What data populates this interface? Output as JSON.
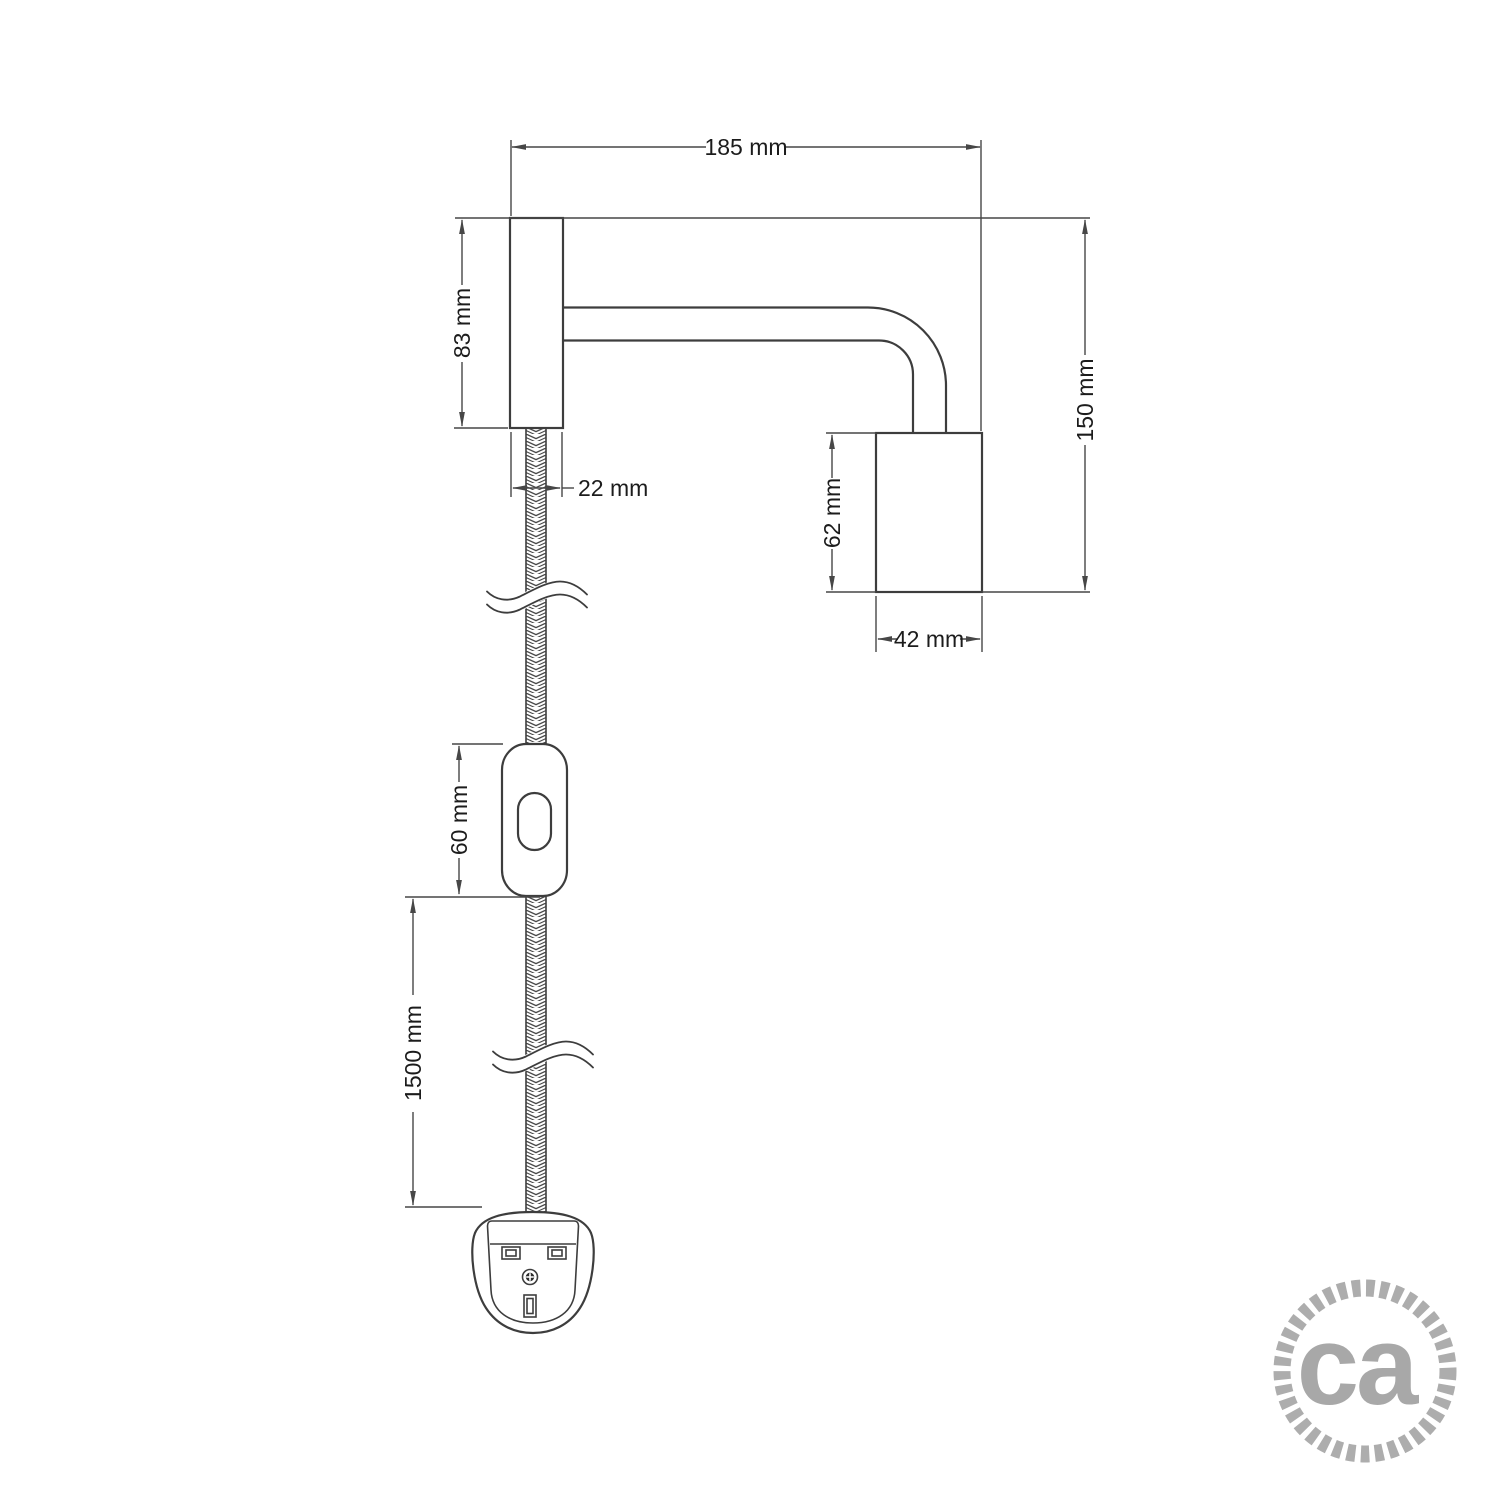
{
  "drawing": {
    "type": "technical-dimension-drawing",
    "subject": "wall-lamp-with-arm-switch-and-plug",
    "labels": {
      "arm_length": "185 mm",
      "wall_plate_height": "83 mm",
      "wall_plate_width": "22 mm",
      "overall_height": "150 mm",
      "lamp_holder_height": "62 mm",
      "lamp_holder_width": "42 mm",
      "switch_length": "60 mm",
      "cable_length": "1500 mm"
    },
    "logo": {
      "text": "ca"
    },
    "colors": {
      "line": "#3d3d3d",
      "dimension_line": "#474747",
      "text": "#1c1c1c",
      "logo_gray": "#a8a8a8",
      "background": "#ffffff"
    }
  }
}
